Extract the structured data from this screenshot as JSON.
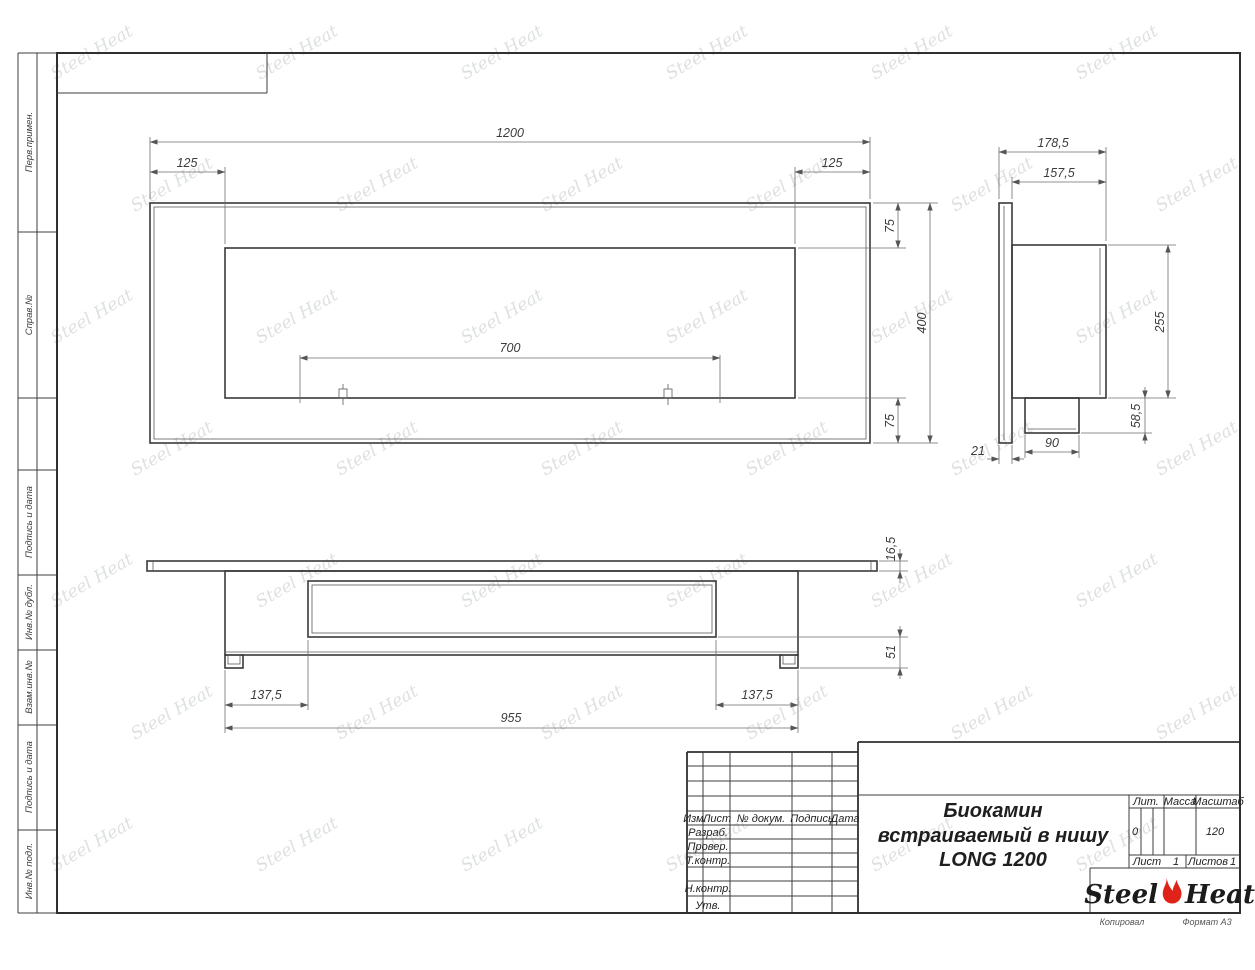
{
  "watermark": {
    "text": "Steel Heat"
  },
  "margin": {
    "labels": [
      "Перв.примен.",
      "Справ.№",
      "Подпись и дата",
      "Инв.№ дубл.",
      "Взам.инв.№",
      "Подпись и дата",
      "Инв.№ подл."
    ]
  },
  "dims": {
    "front": {
      "overall": "1200",
      "left": "125",
      "right": "125",
      "burner": "700",
      "top": "75",
      "height": "400",
      "bottom": "75"
    },
    "side": {
      "overall_depth": "178,5",
      "body_depth": "157,5",
      "inner_height": "255",
      "tray_height": "58,5",
      "tray_width": "90",
      "flange_offset": "21"
    },
    "plan": {
      "plate": "16,5",
      "base": "51",
      "left": "137,5",
      "right": "137,5",
      "length": "955"
    }
  },
  "title_block": {
    "change_header": [
      "Изм.",
      "Лист",
      "№ докум.",
      "Подпись",
      "Дата"
    ],
    "roles": [
      "Разраб.",
      "Провер.",
      "Т.контр.",
      "Н.контр.",
      "Утв."
    ],
    "title_lines": [
      "Биокамин",
      "встраиваемый в нишу",
      "LONG 1200"
    ],
    "lit_label": "Лит.",
    "lit_value": "0",
    "mass_label": "Масса",
    "scale_label": "Масштаб",
    "scale_value": "120",
    "sheet_label": "Лист",
    "sheet_value": "1",
    "sheets_label": "Листов",
    "sheets_value": "1",
    "logo_left": "Steel",
    "logo_right": "Heat",
    "copied_note": "Копировал",
    "format_note": "Формат А3"
  }
}
